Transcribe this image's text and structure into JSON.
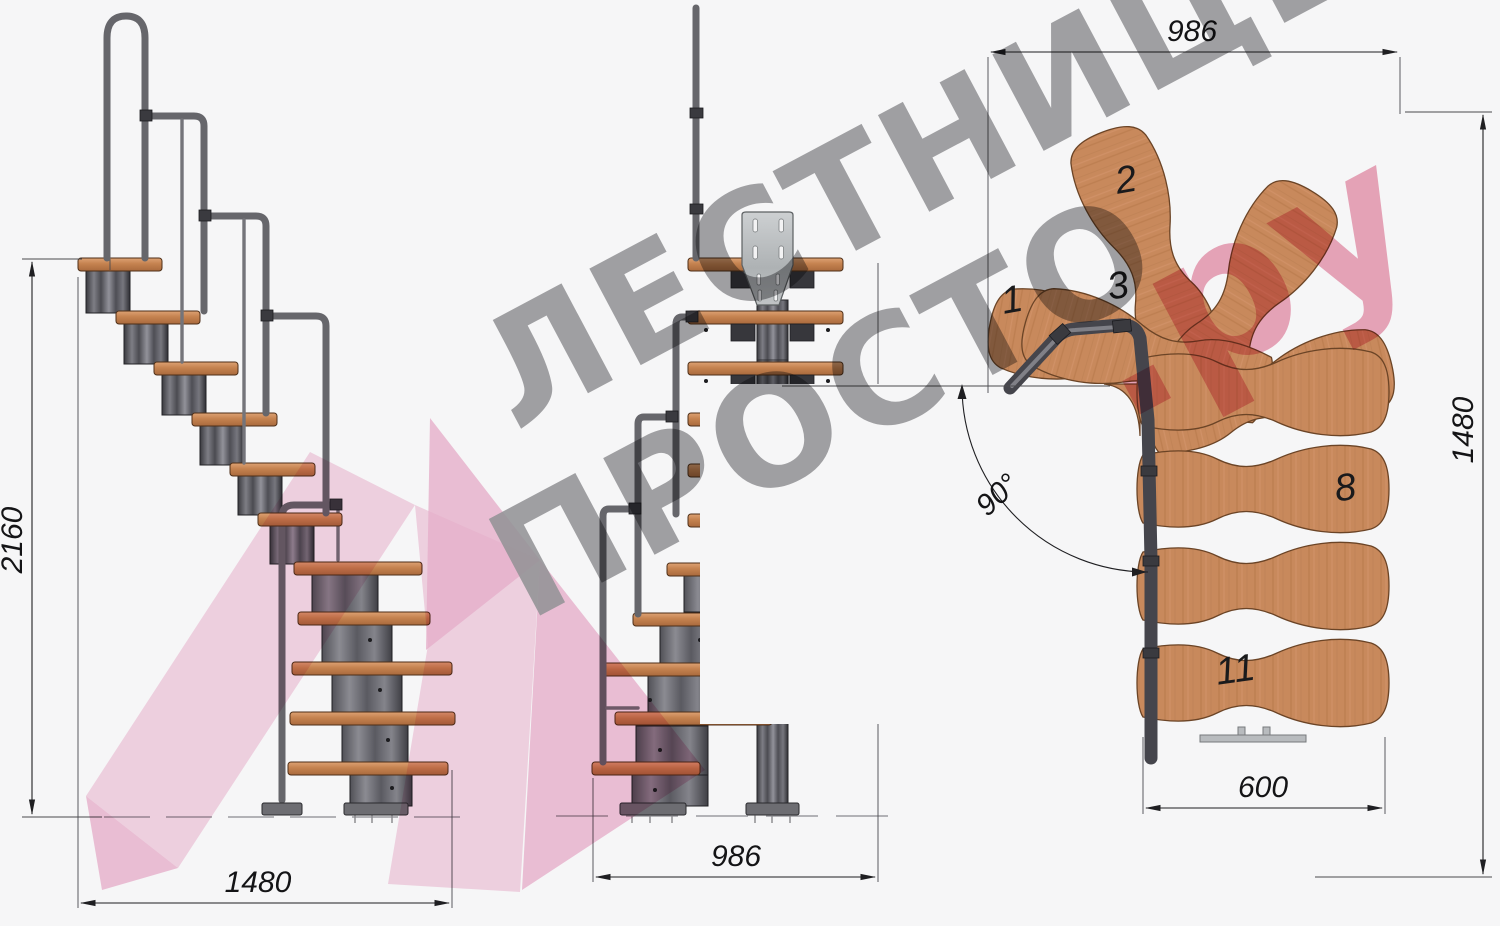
{
  "page": {
    "kind": "technical drawing",
    "subject": "modular staircase with 90-degree turn, three orthographic views",
    "background": "#f6f6f7"
  },
  "views": {
    "side": {
      "title": "side elevation",
      "dims": {
        "height": "2160",
        "length": "1480"
      }
    },
    "front": {
      "title": "front elevation",
      "dims": {
        "width": "986"
      }
    },
    "plan": {
      "title": "top plan",
      "dims": {
        "width_top": "986",
        "depth_right": "1480",
        "tread_bottom": "600",
        "turn_angle": "90°"
      },
      "tread_numbers": [
        "1",
        "2",
        "3",
        "8",
        "11"
      ]
    }
  },
  "watermark": {
    "line1": "ЛЕСТНИЦЫ",
    "line2": "ПРОСТО",
    "suffix": ".ру"
  },
  "colors": {
    "wood": "#c8895c",
    "wood_shadow": "#a96a3d",
    "steel_dark": "#3c3c40",
    "steel_light": "#95959b",
    "rail_gray": "#66666b",
    "dimension_ink": "#1f1f22",
    "watermark_gray": "#98989b",
    "watermark_pink": "#f3c8dc",
    "watermark_accent": "#e892ab"
  }
}
